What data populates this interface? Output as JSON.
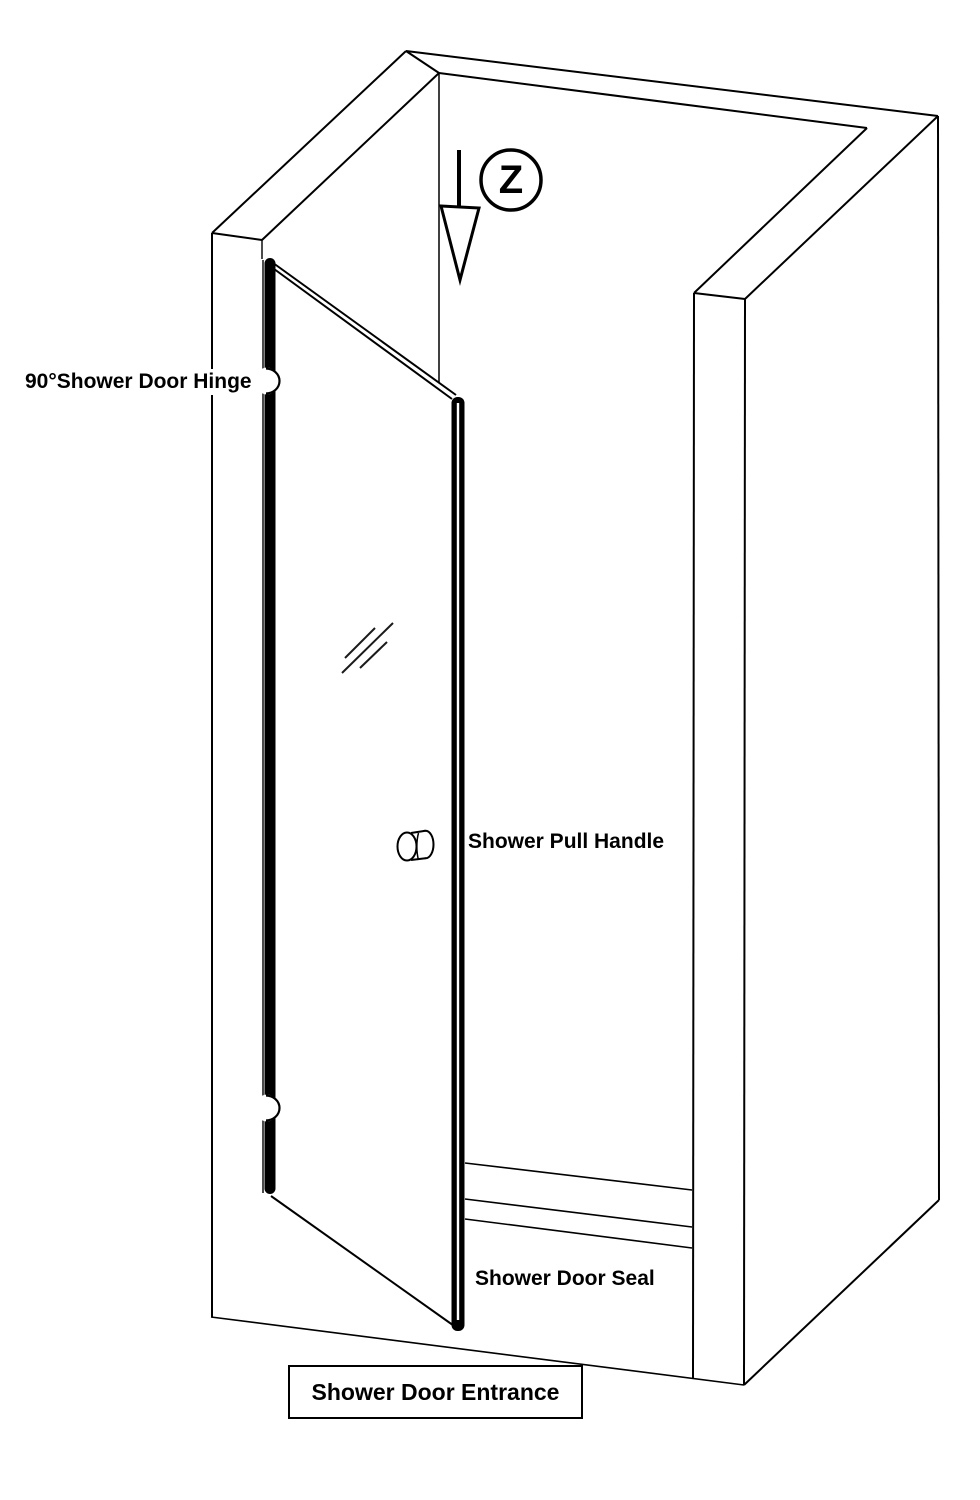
{
  "diagram": {
    "labels": {
      "hinge": "90°Shower Door Hinge",
      "pull_handle": "Shower Pull Handle",
      "door_seal": "Shower Door Seal",
      "entrance": "Shower Door Entrance",
      "view_marker": "Z"
    },
    "colors": {
      "ink": "#000000",
      "paper": "#ffffff"
    }
  }
}
